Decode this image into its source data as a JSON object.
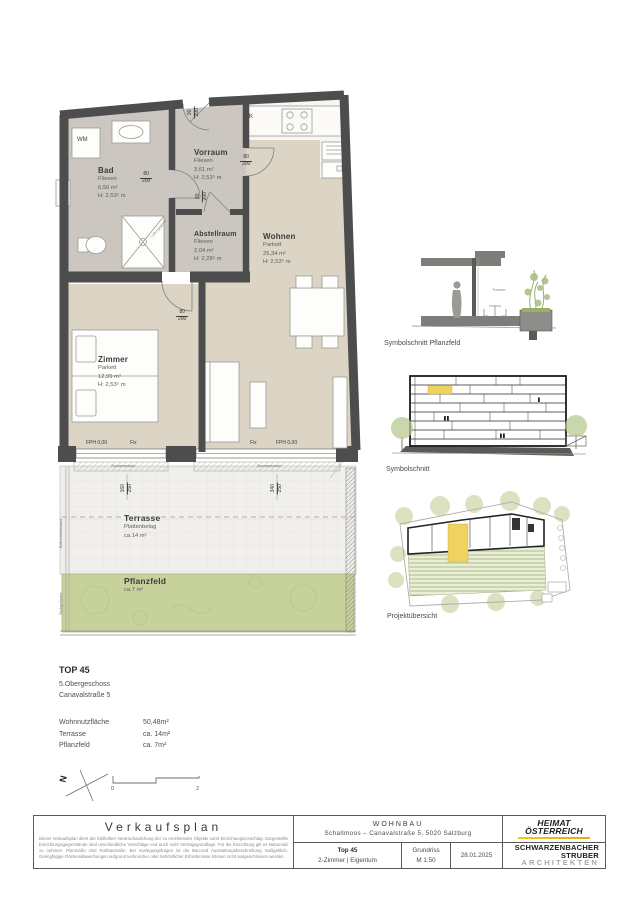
{
  "plan": {
    "rooms": {
      "bad": {
        "name": "Bad",
        "finish": "Fliesen",
        "area": "6,50 m²",
        "height": "H: 2,53⁵ m"
      },
      "vorraum": {
        "name": "Vorraum",
        "finish": "Fliesen",
        "area": "3,61 m²",
        "height": "H: 2,53⁵ m"
      },
      "abstellraum": {
        "name": "Abstellraum",
        "finish": "Fliesen",
        "area": "2,04 m²",
        "height": "H: 2,28⁵ m"
      },
      "wohnen": {
        "name": "Wohnen",
        "finish": "Parkett",
        "area": "25,34 m²",
        "height": "H: 2,53⁵ m"
      },
      "zimmer": {
        "name": "Zimmer",
        "finish": "Parkett",
        "area": "12,99 m²",
        "height": "H: 2,53⁵ m"
      },
      "terrasse": {
        "name": "Terrasse",
        "finish": "Plattenbelag",
        "area": "ca.14 m²"
      },
      "pflanzfeld": {
        "name": "Pflanzfeld",
        "area": "ca.7 m²"
      }
    },
    "fixtures": {
      "wm": "WM",
      "kitchen": "K"
    },
    "doors": {
      "w80": {
        "top": "80",
        "bottom": "200"
      },
      "entry": {
        "top": "90",
        "bottom": "200"
      }
    },
    "windows": {
      "left": {
        "top": "160",
        "bottom": "250"
      },
      "right": {
        "top": "340",
        "bottom": "250"
      },
      "fph": "FPH 0,00",
      "fix": "Fix",
      "sonnenschutz": "Sonnenschutz"
    },
    "annotations": {
      "lueftung": "Lüftungsgerät",
      "trennwand": "Balkontrennwand",
      "gelaender": "Stabgeländer"
    }
  },
  "diagrams": {
    "section_pflanzfeld": {
      "caption": "Symbolschnitt Pflanzfeld",
      "label_terrasse": "Terrasse",
      "label_pflanzfeld": "Pflanzfeld"
    },
    "section": {
      "caption": "Symbolschnitt"
    },
    "overview": {
      "caption": "Projektübersicht"
    }
  },
  "unit": {
    "title": "TOP 45",
    "floor": "5.Obergeschoss",
    "address": "Canavalstraße 5",
    "metrics": [
      {
        "label": "Wohnnutzfläche",
        "value": "50,48m²"
      },
      {
        "label": "Terrasse",
        "value": "ca. 14m²"
      },
      {
        "label": "Pflanzfeld",
        "value": "ca. 7m²"
      }
    ]
  },
  "north": {
    "label": "N"
  },
  "scalebar": {
    "start": "0",
    "end": "2"
  },
  "titleblock": {
    "plan_type": "Verkaufsplan",
    "disclaimer": "Dieser Verkaufsplan dient der bildhaften Veranschaulichung der zu errichtenden Objekte samt Einrichtungsvorschlag. Dargestellte Einrichtungsgegenstände sind unverbindliche Vorschläge und auch nicht Vertragsgrundlage. Für die Einrichtung gilt es Naturmaß zu nehmen. Planmaße sind Rohbaumaße. Bei Auslegungsfragen ist die Bau-und Ausstattungsbeschreibung maßgeblich. Geringfügige Flächenabweichungen aufgrund technischer oder behördlicher Erfordernisse können nicht ausgeschlossen werden.",
    "project_type": "WOHNBAU",
    "project_address": "Schallmoos – Canavalstraße 5, 5020 Salzburg",
    "unit": "Top 45",
    "unit_sub": "2-Zimmer | Eigentum",
    "drawing": "Grundriss",
    "scale": "M 1:50",
    "date": "28.01.2025",
    "logo1_line1": "HEIMAT",
    "logo1_line2": "ÖSTERREICH",
    "logo2_line1": "SCHWARZENBACHER",
    "logo2_line2": "STRUBER",
    "logo2_line3": "ARCHITEKTEN"
  },
  "colors": {
    "wall": "#4d4d4d",
    "tile": "#cbc7c0",
    "parkett": "#dcd4c5",
    "terrace": "#f0efec",
    "green": "#c6d19b",
    "highlight": "#eed45f"
  }
}
